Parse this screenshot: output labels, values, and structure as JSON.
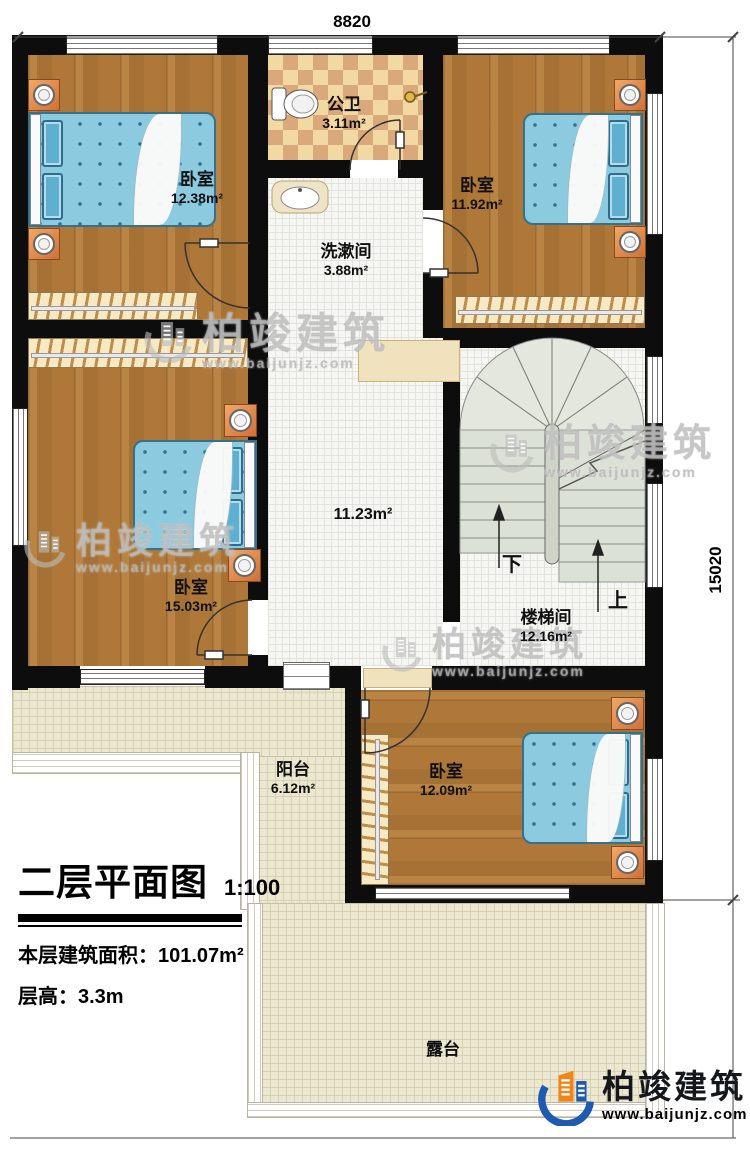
{
  "dimensions": {
    "width_mm": "8820",
    "height_mm": "15020"
  },
  "rooms": [
    {
      "name": "卧室",
      "area": "12.38m²"
    },
    {
      "name": "公卫",
      "area": "3.11m²"
    },
    {
      "name": "卧室",
      "area": "11.92m²"
    },
    {
      "name": "洗漱间",
      "area": "3.88m²"
    },
    {
      "name": "",
      "area": "11.23m²"
    },
    {
      "name": "卧室",
      "area": "15.03m²"
    },
    {
      "name": "楼梯间",
      "area": "12.16m²"
    },
    {
      "name": "阳台",
      "area": "6.12m²"
    },
    {
      "name": "卧室",
      "area": "12.09m²"
    },
    {
      "name": "露台",
      "area": ""
    }
  ],
  "stairs": {
    "down_label": "下",
    "up_label": "上"
  },
  "title_block": {
    "title": "二层平面图",
    "scale": "1:100",
    "area_label": "本层建筑面积：",
    "area_value": "101.07m²",
    "height_label": "层高：",
    "height_value": "3.3m"
  },
  "branding": {
    "brand": "柏竣建筑",
    "url": "www.baijunjz.com"
  },
  "colors": {
    "wall": "#0d0d0d",
    "wood_floor": "#af7838",
    "bathroom_tile_tan": "#d9a97c",
    "bed_blue": "#8ccadf",
    "outdoor_beige": "#ece7d0",
    "logo_blue": "#1e5bb0",
    "logo_orange": "#f08519"
  }
}
